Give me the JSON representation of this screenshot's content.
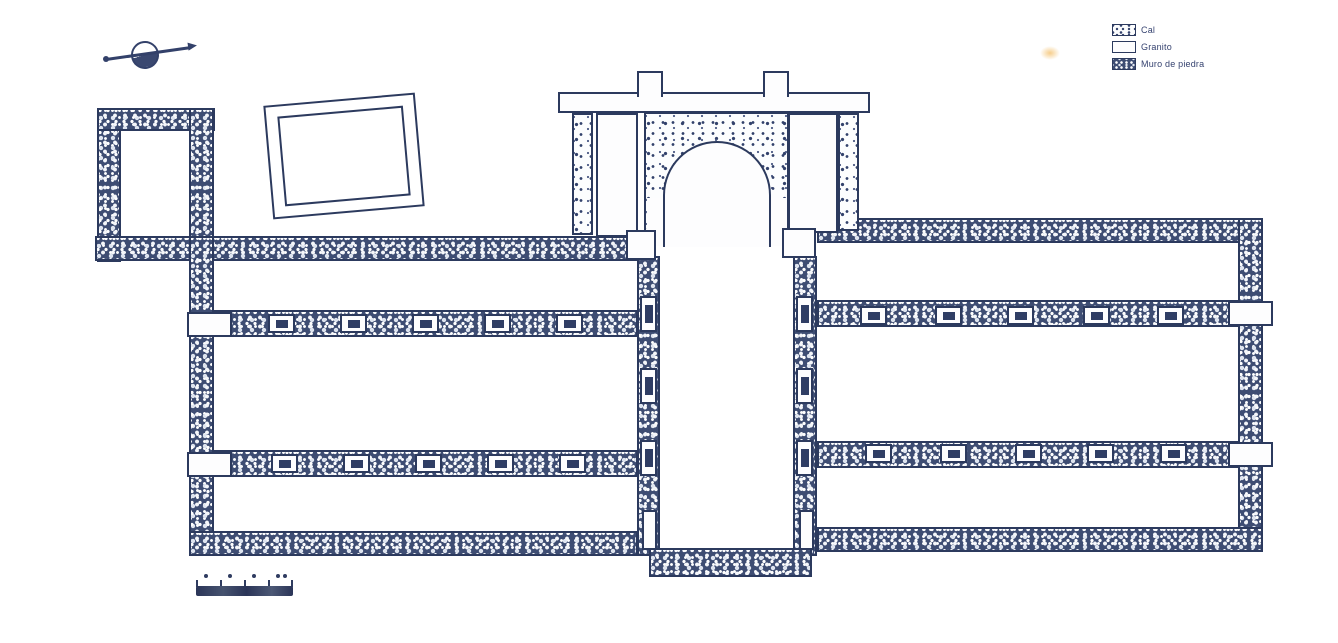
{
  "title": "Plano de planta (dibujo escaneado)",
  "legend": {
    "items": [
      {
        "label": "Cal",
        "swatch": "cal"
      },
      {
        "label": "Granito",
        "swatch": "granito"
      },
      {
        "label": "Muro de piedra",
        "swatch": "stone"
      }
    ]
  },
  "colors": {
    "ink": "#2c3a5e",
    "stone_fill": "#3e4d73",
    "paper": "#ffffff",
    "scan_speck": "#f6cd8a"
  },
  "compass": {
    "type": "north-arrow",
    "direction": "upper-right"
  },
  "scale_bar": {
    "segments": 4,
    "tick_count": 5,
    "dot_count": 4
  },
  "plan": {
    "column_bases": [
      {
        "x": 268,
        "y": 314
      },
      {
        "x": 340,
        "y": 314
      },
      {
        "x": 412,
        "y": 314
      },
      {
        "x": 484,
        "y": 314
      },
      {
        "x": 556,
        "y": 314
      },
      {
        "x": 271,
        "y": 454
      },
      {
        "x": 343,
        "y": 454
      },
      {
        "x": 415,
        "y": 454
      },
      {
        "x": 487,
        "y": 454
      },
      {
        "x": 559,
        "y": 454
      },
      {
        "x": 860,
        "y": 306
      },
      {
        "x": 935,
        "y": 306
      },
      {
        "x": 1007,
        "y": 306
      },
      {
        "x": 1083,
        "y": 306
      },
      {
        "x": 1157,
        "y": 306
      },
      {
        "x": 865,
        "y": 444
      },
      {
        "x": 940,
        "y": 444
      },
      {
        "x": 1015,
        "y": 444
      },
      {
        "x": 1087,
        "y": 444
      },
      {
        "x": 1160,
        "y": 444
      }
    ],
    "wall_blocks": [
      {
        "x": 640,
        "y": 296
      },
      {
        "x": 640,
        "y": 368
      },
      {
        "x": 640,
        "y": 440
      },
      {
        "x": 796,
        "y": 296
      },
      {
        "x": 796,
        "y": 368
      },
      {
        "x": 796,
        "y": 440
      }
    ],
    "bottom_slots": [
      {
        "x": 642,
        "y": 510
      },
      {
        "x": 799,
        "y": 510
      }
    ],
    "quoins": [
      {
        "x": 187,
        "y": 312
      },
      {
        "x": 187,
        "y": 452
      },
      {
        "x": 1228,
        "y": 301
      },
      {
        "x": 1228,
        "y": 442
      }
    ]
  }
}
